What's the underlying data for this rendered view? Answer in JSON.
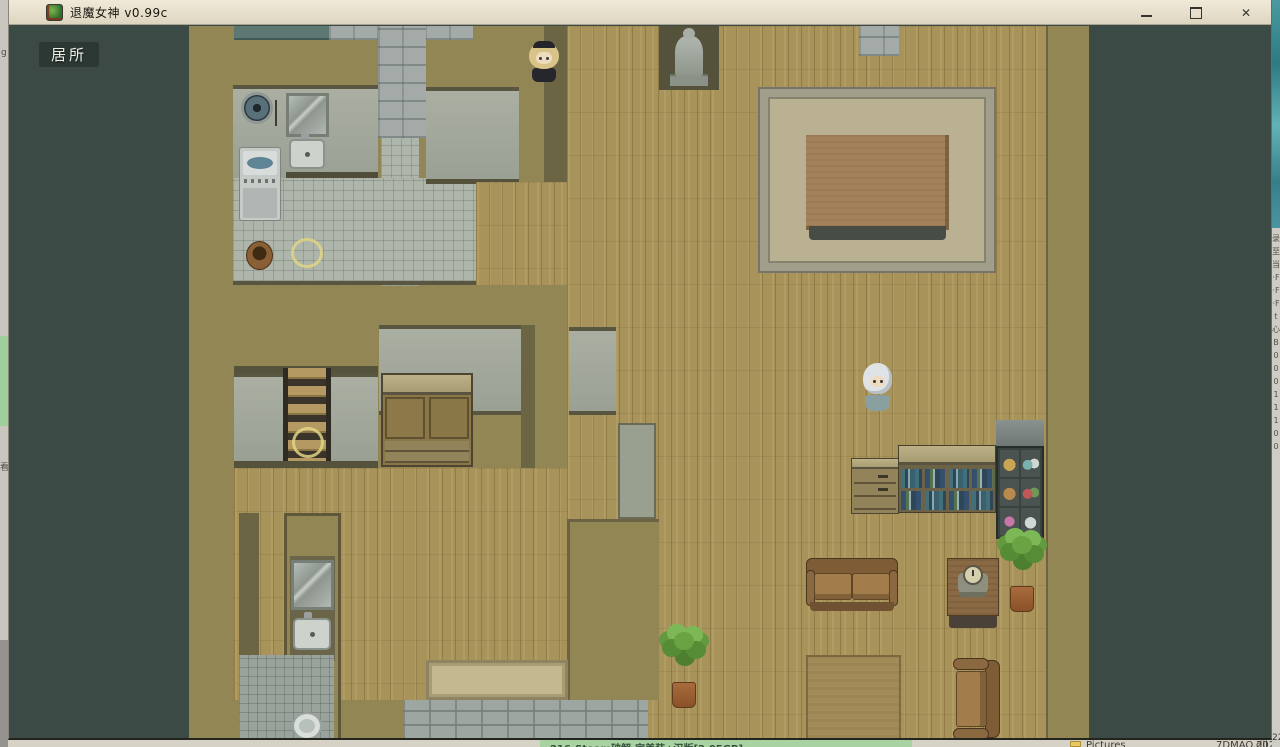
{
  "window": {
    "title": "退魔女神 v0.99c",
    "close_glyph": "✕"
  },
  "game": {
    "location_label": "居所"
  },
  "colors": {
    "titlebar": "#e9e2d0",
    "letterbox": "#3b4a45",
    "interaction_marker": "#e0d583",
    "wood_floor": "#a8935a"
  },
  "background": {
    "left_strip": {
      "fragment_top": "g",
      "fragment_mid": "看"
    },
    "right_strip": {
      "fragments_text": "录\n至\n当\n·F\n·F\n·F\nt\n心\nB\n0\n0\n0\n1\n1\n1\n0\n0",
      "bottom_fragment": "22"
    },
    "bottom_strip": {
      "archive_title": "216-Steam破解-完美装+汉版[2.05GB]",
      "pictures_label": "Pictures",
      "dll_label": "7DMAO.dll",
      "year_fragment": "2022.0"
    }
  }
}
